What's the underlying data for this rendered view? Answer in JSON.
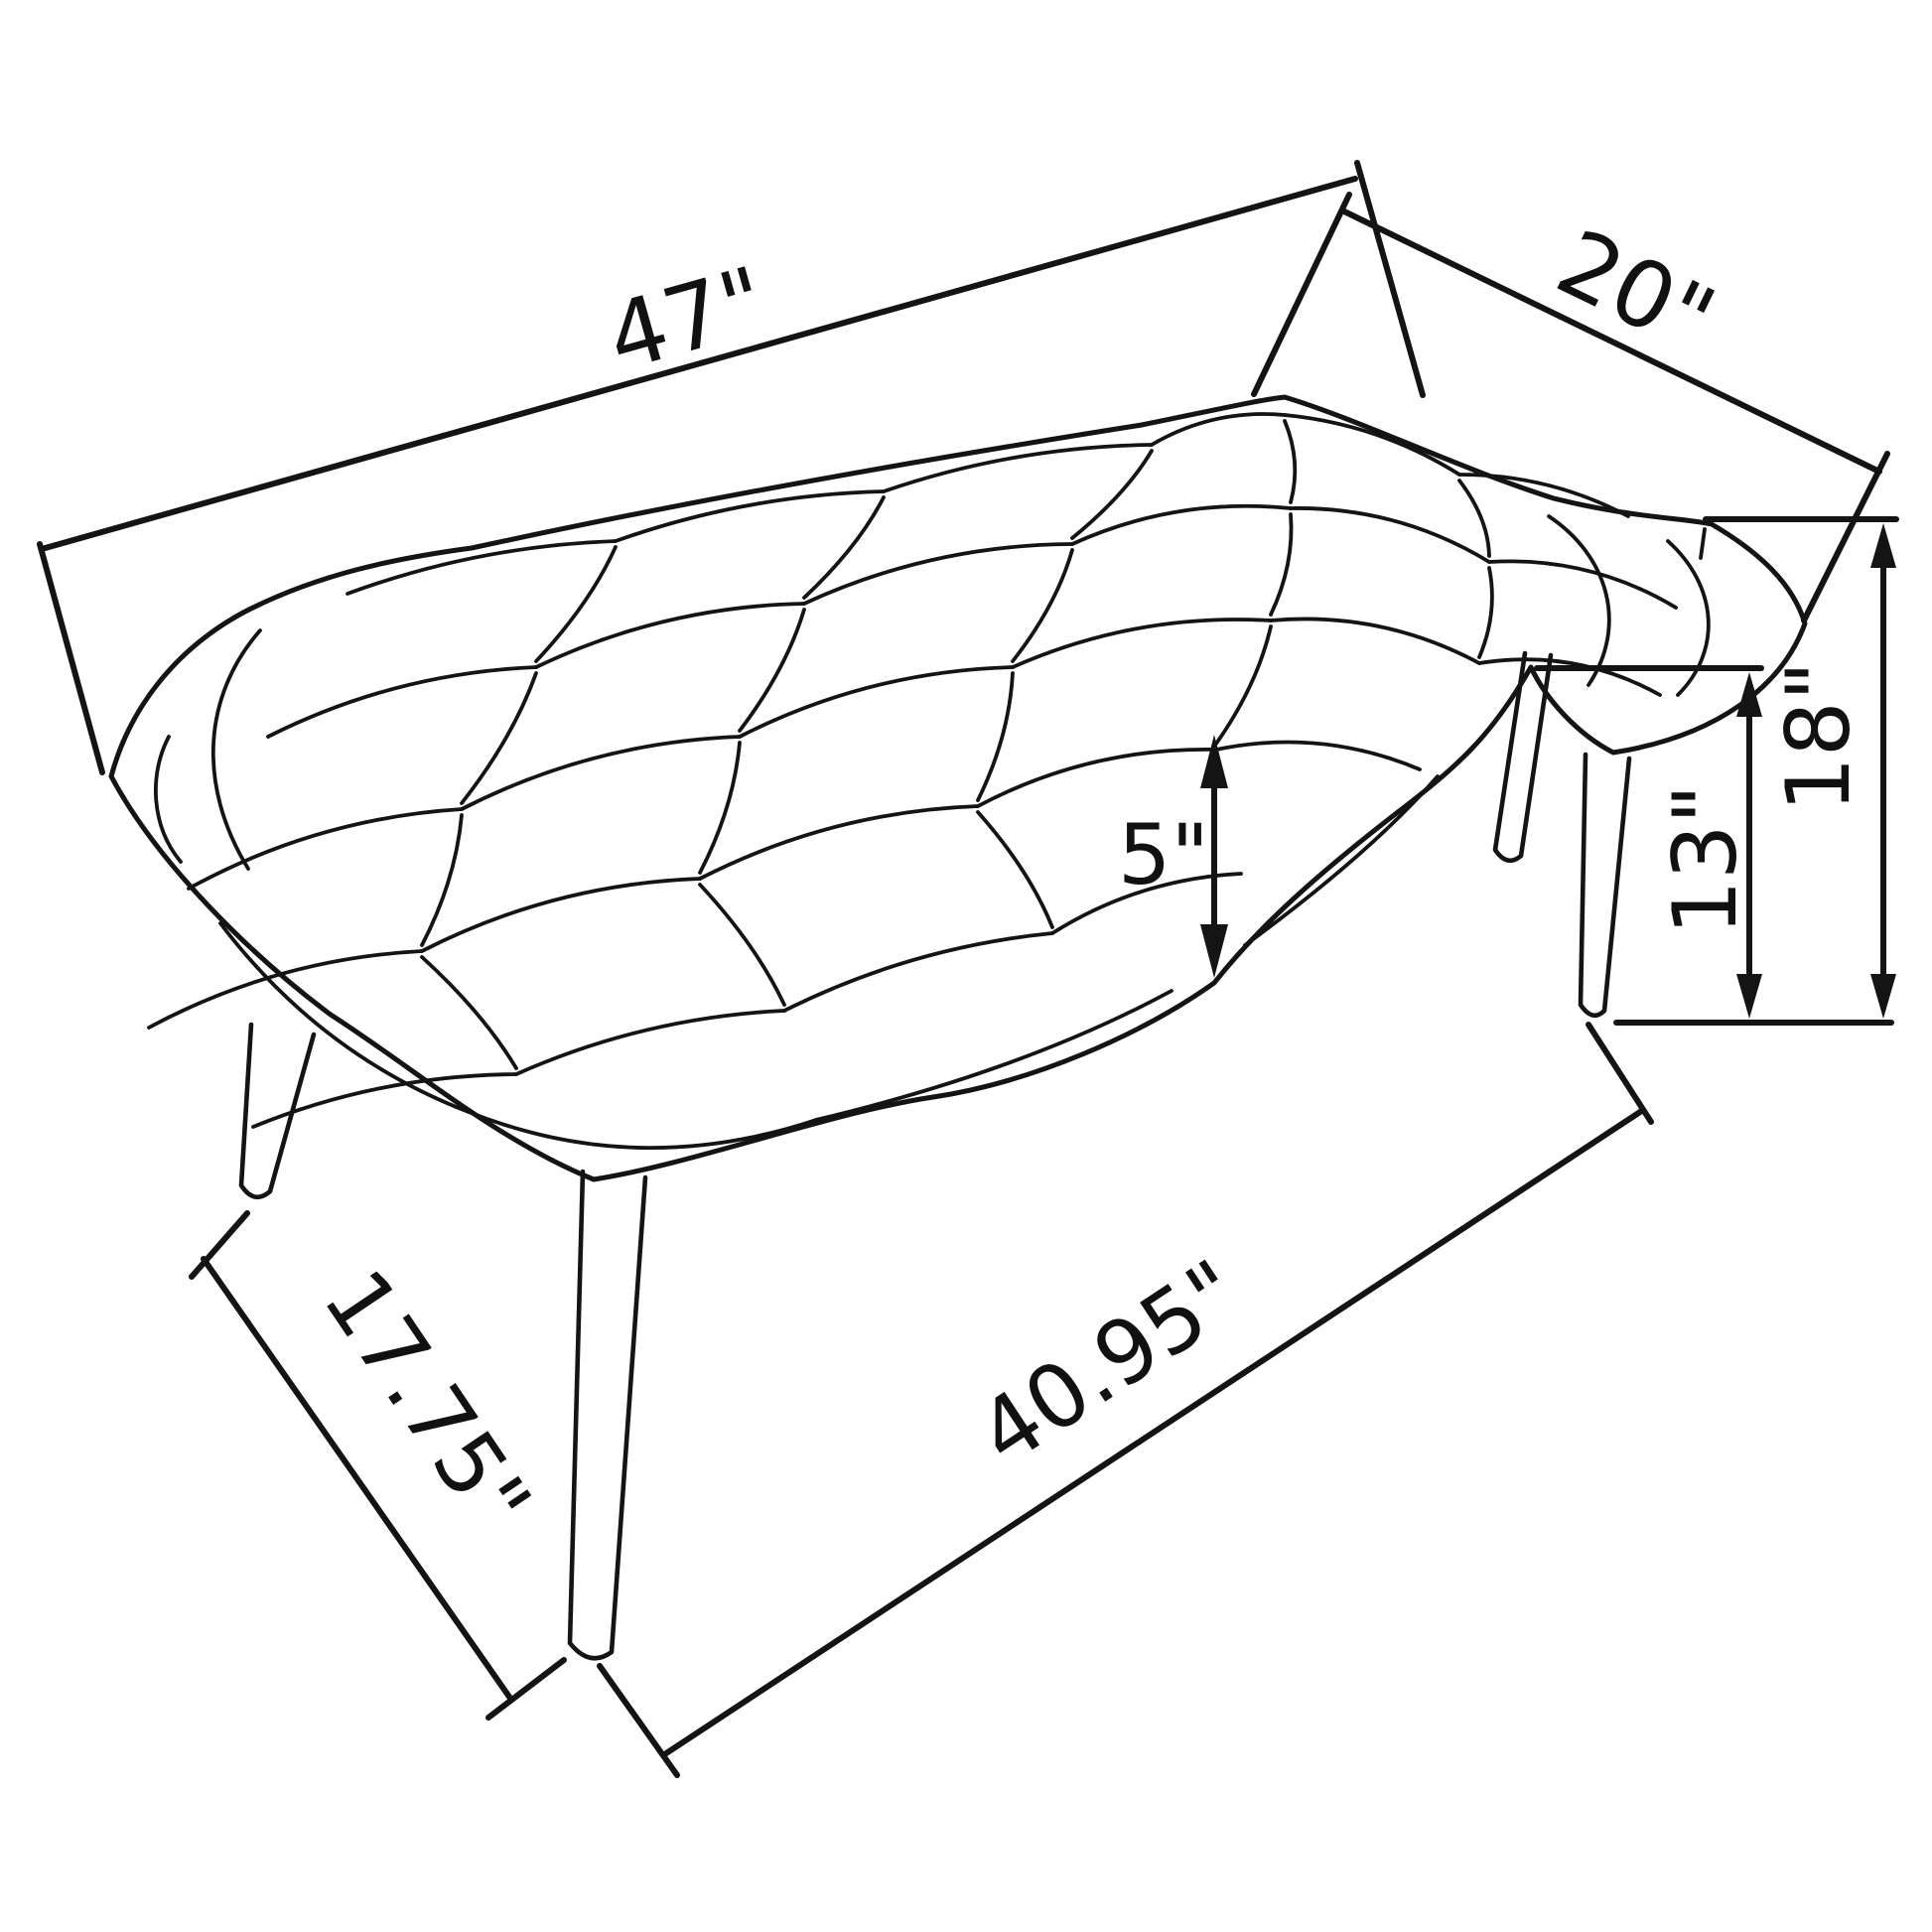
{
  "page": {
    "background_color": "#ffffff",
    "line_color": "#141414",
    "description": "Technical dimension line drawing of a button-tufted bench with four splayed tapered legs"
  },
  "diagram": {
    "subject": "tufted-bench",
    "dimensions": {
      "length_top": {
        "label": "47\""
      },
      "depth_top": {
        "label": "20\""
      },
      "overall_height": {
        "label": "18\""
      },
      "leg_height": {
        "label": "13\""
      },
      "cushion_thickness": {
        "label": "5\""
      },
      "leg_spread_side": {
        "label": "17.75\""
      },
      "leg_spread_front": {
        "label": "40.95\""
      }
    }
  }
}
